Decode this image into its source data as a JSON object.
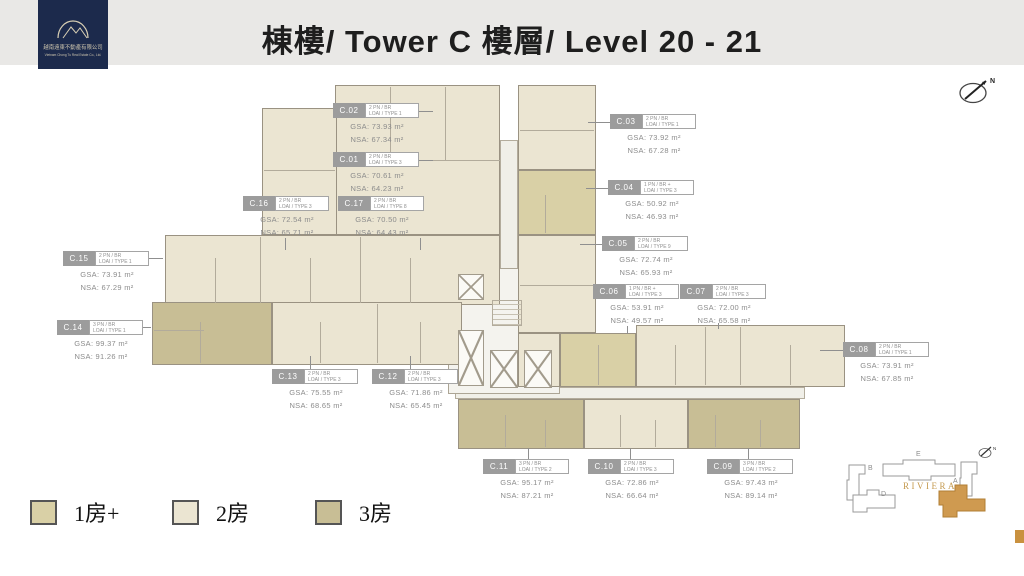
{
  "header": {
    "title": "棟樓/ Tower C  樓層/ Level 20 - 21"
  },
  "logo": {
    "company_zh": "越南遠東不動產有限公司",
    "company_en": "Vietnam Chong Tu Real Estate Co., Ltd.",
    "bg_color": "#1c2a4c"
  },
  "labels": {
    "gsa": "GSA:",
    "nsa": "NSA:"
  },
  "compass": {
    "label": "N"
  },
  "units": [
    {
      "id": "C.01",
      "type1": "2 PN / BR",
      "type2": "LOAI / TYPE 3",
      "gsa": "70.61 m²",
      "nsa": "64.23 m²"
    },
    {
      "id": "C.02",
      "type1": "2 PN / BR",
      "type2": "LOAI / TYPE 1",
      "gsa": "73.93 m²",
      "nsa": "67.34 m²"
    },
    {
      "id": "C.03",
      "type1": "2 PN / BR",
      "type2": "LOAI / TYPE 1",
      "gsa": "73.92 m²",
      "nsa": "67.28 m²"
    },
    {
      "id": "C.04",
      "type1": "1 PN / BR +",
      "type2": "LOAI / TYPE 3",
      "gsa": "50.92 m²",
      "nsa": "46.93 m²"
    },
    {
      "id": "C.05",
      "type1": "2 PN / BR",
      "type2": "LOAI / TYPE 9",
      "gsa": "72.74 m²",
      "nsa": "65.93 m²"
    },
    {
      "id": "C.06",
      "type1": "1 PN / BR +",
      "type2": "LOAI / TYPE 3",
      "gsa": "53.91 m²",
      "nsa": "49.57 m²"
    },
    {
      "id": "C.07",
      "type1": "2 PN / BR",
      "type2": "LOAI / TYPE 3",
      "gsa": "72.00 m²",
      "nsa": "65.58 m²"
    },
    {
      "id": "C.08",
      "type1": "2 PN / BR",
      "type2": "LOAI / TYPE 1",
      "gsa": "73.91 m²",
      "nsa": "67.85 m²"
    },
    {
      "id": "C.09",
      "type1": "3 PN / BR",
      "type2": "LOAI / TYPE 2",
      "gsa": "97.43 m²",
      "nsa": "89.14 m²"
    },
    {
      "id": "C.10",
      "type1": "2 PN / BR",
      "type2": "LOAI / TYPE 3",
      "gsa": "72.86 m²",
      "nsa": "66.64 m²"
    },
    {
      "id": "C.11",
      "type1": "3 PN / BR",
      "type2": "LOAI / TYPE 2",
      "gsa": "95.17 m²",
      "nsa": "87.21 m²"
    },
    {
      "id": "C.12",
      "type1": "2 PN / BR",
      "type2": "LOAI / TYPE 3",
      "gsa": "71.86 m²",
      "nsa": "65.45 m²"
    },
    {
      "id": "C.13",
      "type1": "2 PN / BR",
      "type2": "LOAI / TYPE 3",
      "gsa": "75.55 m²",
      "nsa": "68.65 m²"
    },
    {
      "id": "C.14",
      "type1": "3 PN / BR",
      "type2": "LOAI / TYPE 1",
      "gsa": "99.37 m²",
      "nsa": "91.26 m²"
    },
    {
      "id": "C.15",
      "type1": "2 PN / BR",
      "type2": "LOAI / TYPE 1",
      "gsa": "73.91 m²",
      "nsa": "67.29 m²"
    },
    {
      "id": "C.16",
      "type1": "2 PN / BR",
      "type2": "LOAI / TYPE 3",
      "gsa": "72.54 m²",
      "nsa": "65.71 m²"
    },
    {
      "id": "C.17",
      "type1": "2 PN / BR",
      "type2": "LOAI / TYPE 8",
      "gsa": "70.50 m²",
      "nsa": "64.43 m²"
    }
  ],
  "legend": [
    {
      "label": "1房+",
      "color": "#d9d0a6"
    },
    {
      "label": "2房",
      "color": "#ebe5d2"
    },
    {
      "label": "3房",
      "color": "#c8be95"
    }
  ],
  "site_map": {
    "project": "RIVIERA",
    "project_color": "#c59a4f",
    "highlight_building": "C",
    "highlight_color": "#cf9a50",
    "buildings": [
      {
        "id": "B"
      },
      {
        "id": "E"
      },
      {
        "id": "A"
      },
      {
        "id": "D"
      },
      {
        "id": "C"
      }
    ],
    "compass": "N"
  }
}
